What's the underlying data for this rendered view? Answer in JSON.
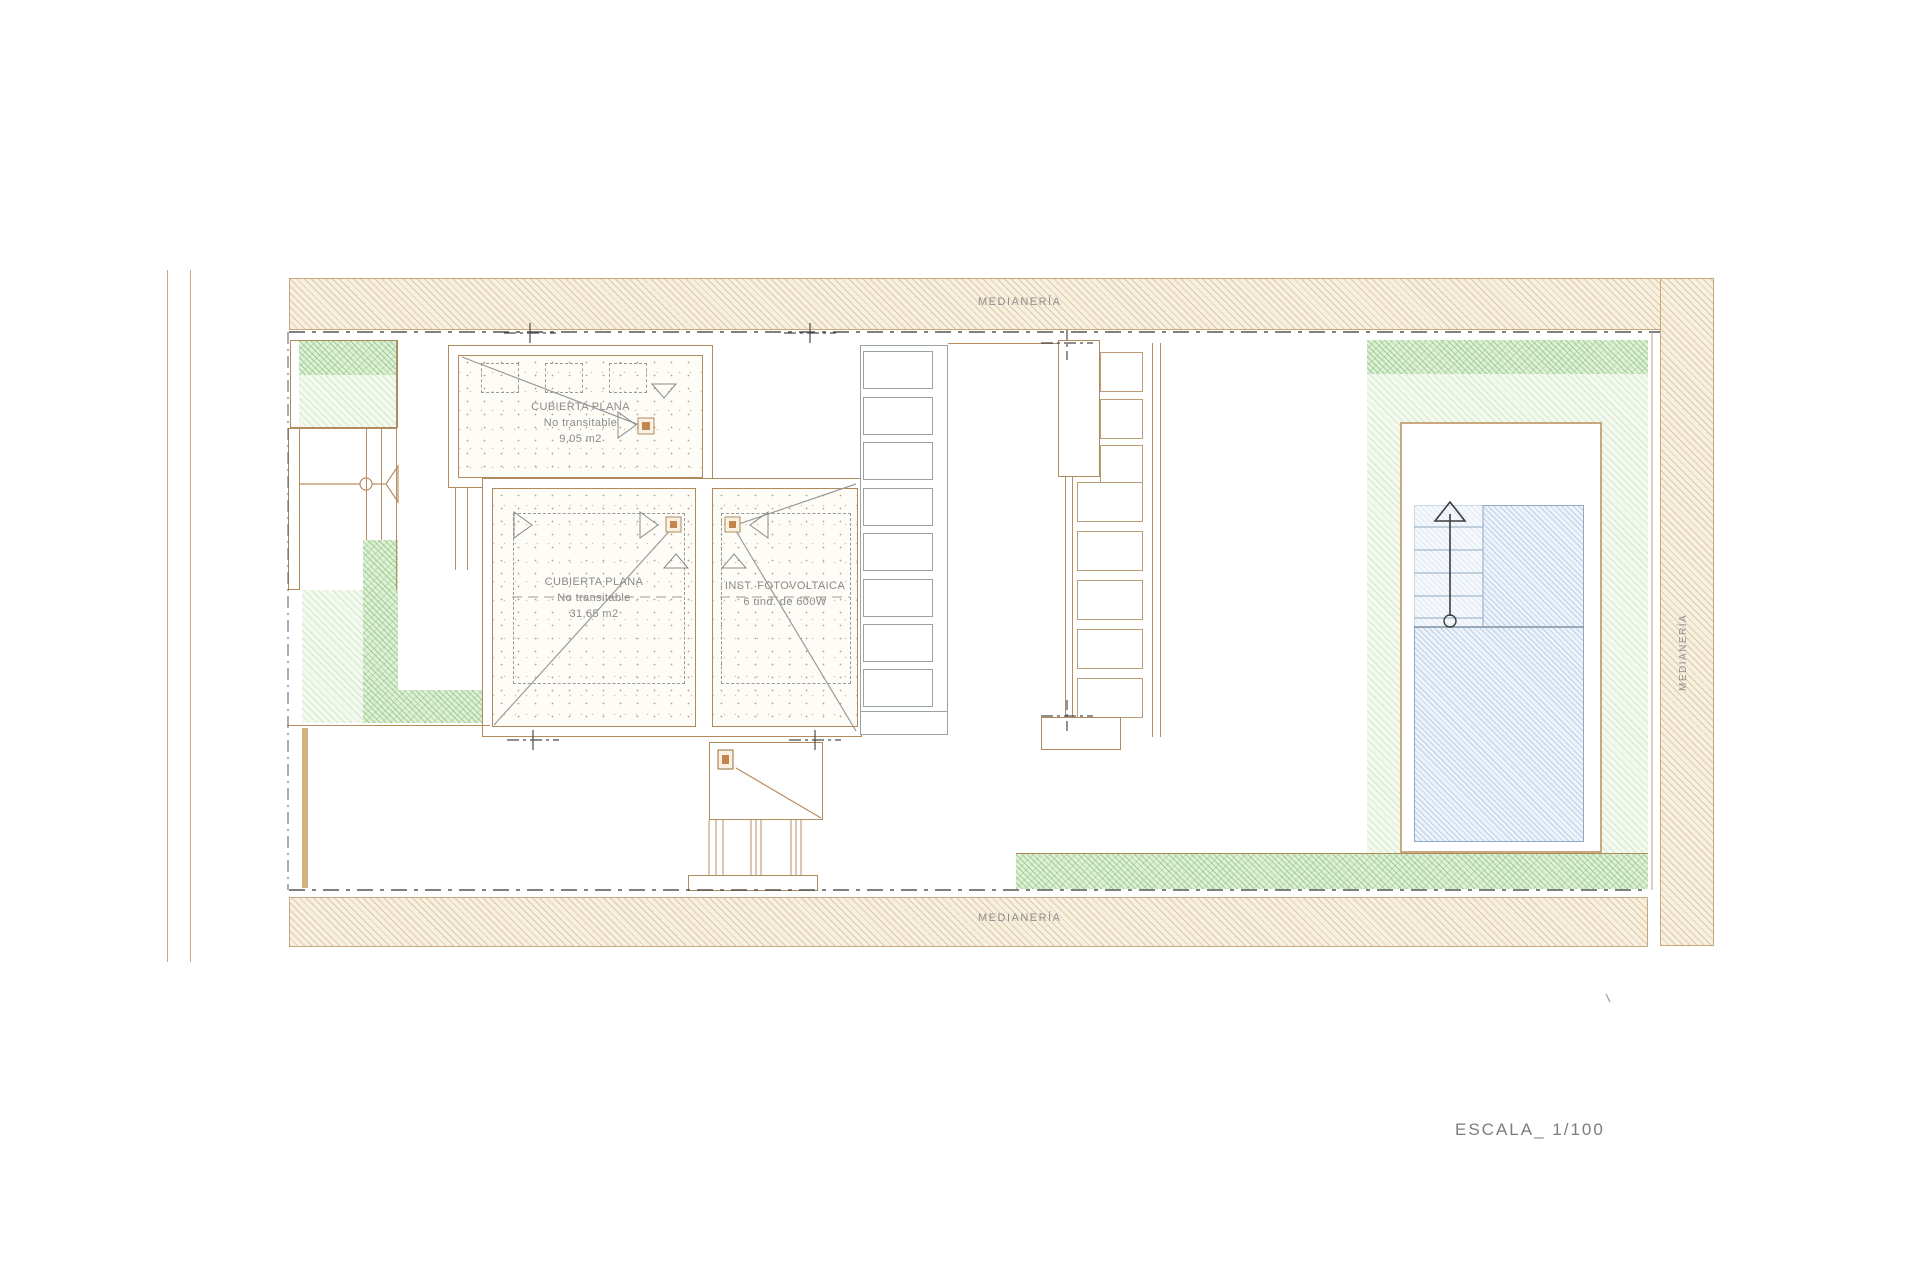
{
  "drawing": {
    "type_note": "roof and site plan",
    "scale_label": "ESCALA_ 1/100"
  },
  "boundaries": {
    "top_label": "MEDIANERÍA",
    "bottom_label": "MEDIANERÍA",
    "right_label": "MEDIANERÍA"
  },
  "roofs": {
    "small_flat_roof": {
      "name": "CUBIERTA PLANA",
      "note": "No transitable",
      "area": "9,05 m2"
    },
    "main_flat_roof": {
      "name": "CUBIERTA PLANA",
      "note": "No transitable",
      "area": "31,65 m2"
    },
    "photovoltaic": {
      "name": "INST. FOTOVOLTAICA",
      "detail": "6 und. de 600W"
    }
  },
  "colors": {
    "wall_tan": "#b08a5c",
    "hatch_tan_bg": "#f7f0e0",
    "garden_green": "#6cb05c",
    "pool_blue": "#7696be",
    "label_gray": "#8f8f8f",
    "boundary_dash": "#555555"
  }
}
